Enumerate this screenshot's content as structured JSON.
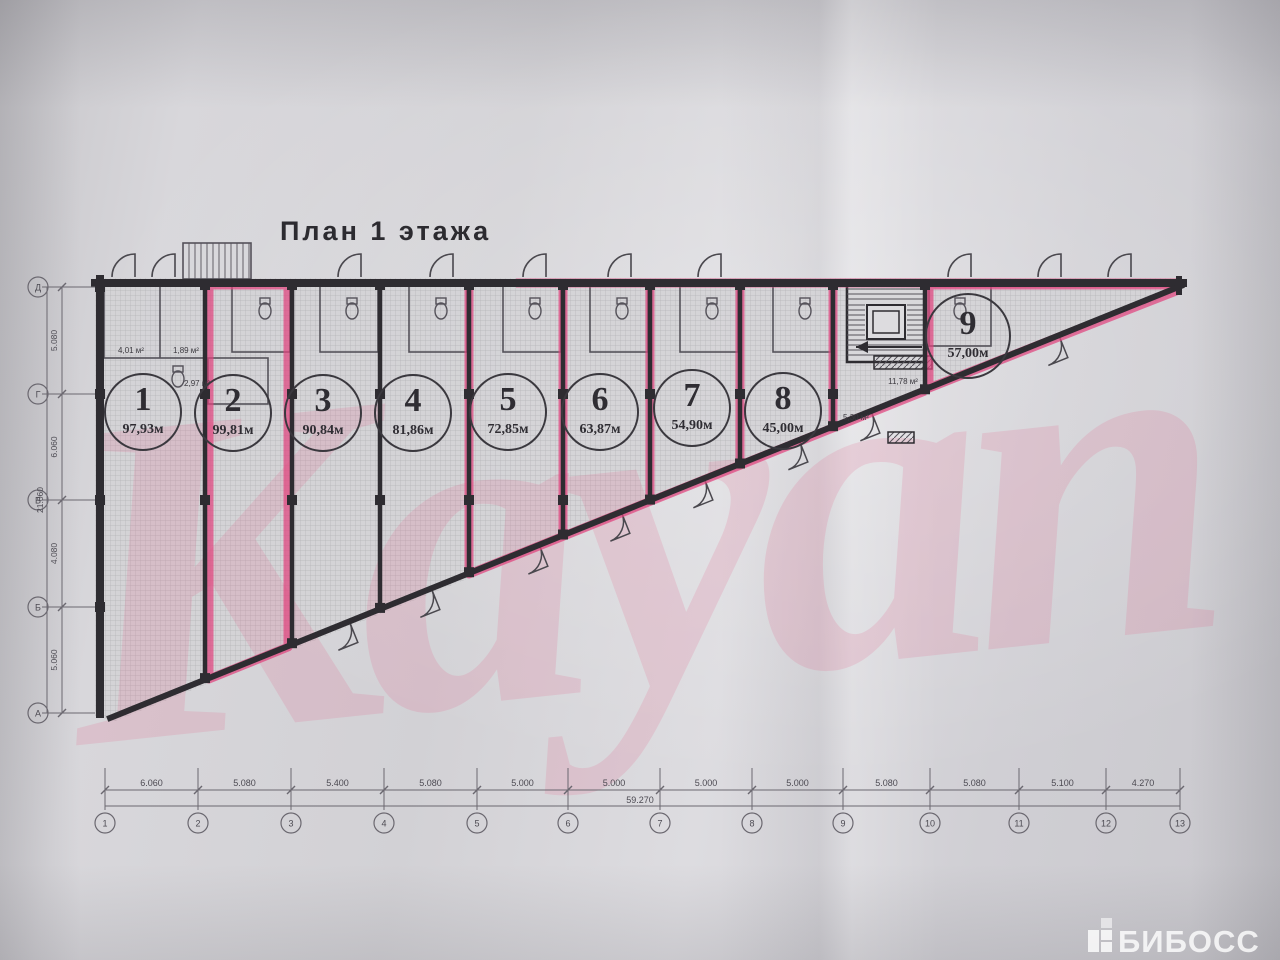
{
  "photo": {
    "watermark_text": "Kayan",
    "logo_text": "БИБОСС"
  },
  "plan": {
    "title": "План 1 этажа",
    "units": [
      {
        "num": "1",
        "area": "97,93м"
      },
      {
        "num": "2",
        "area": "99,81м"
      },
      {
        "num": "3",
        "area": "90,84м"
      },
      {
        "num": "4",
        "area": "81,86м"
      },
      {
        "num": "5",
        "area": "72,85м"
      },
      {
        "num": "6",
        "area": "63,87м"
      },
      {
        "num": "7",
        "area": "54,90м"
      },
      {
        "num": "8",
        "area": "45,00м"
      },
      {
        "num": "9",
        "area": "57,00м"
      }
    ],
    "small_areas": [
      "4,01 м²",
      "1,89 м²",
      "2,97 м²",
      "11,78 м²",
      "5,30 м²"
    ],
    "axis_rows": [
      "Д",
      "Г",
      "В",
      "Б",
      "А"
    ],
    "axis_cols": [
      "1",
      "2",
      "3",
      "4",
      "5",
      "6",
      "7",
      "8",
      "9",
      "10",
      "11",
      "12",
      "13"
    ],
    "dims_left": [
      "5.080",
      "6.060",
      "4.080",
      "5.060"
    ],
    "dims_left_total": "21.060",
    "dims_bottom": [
      "6.060",
      "5.080",
      "5.400",
      "5.080",
      "5.000",
      "5.000",
      "5.000",
      "5.000",
      "5.080",
      "5.080",
      "5.100",
      "4.270"
    ],
    "dims_bottom_total": "59.270",
    "colors": {
      "line": "#2e2c31",
      "soft_line": "#55525a",
      "dim_line": "#6b6870",
      "highlight": "#e0447e",
      "watermark": "#e45c86",
      "fill_base": "#d6d5d8"
    }
  }
}
